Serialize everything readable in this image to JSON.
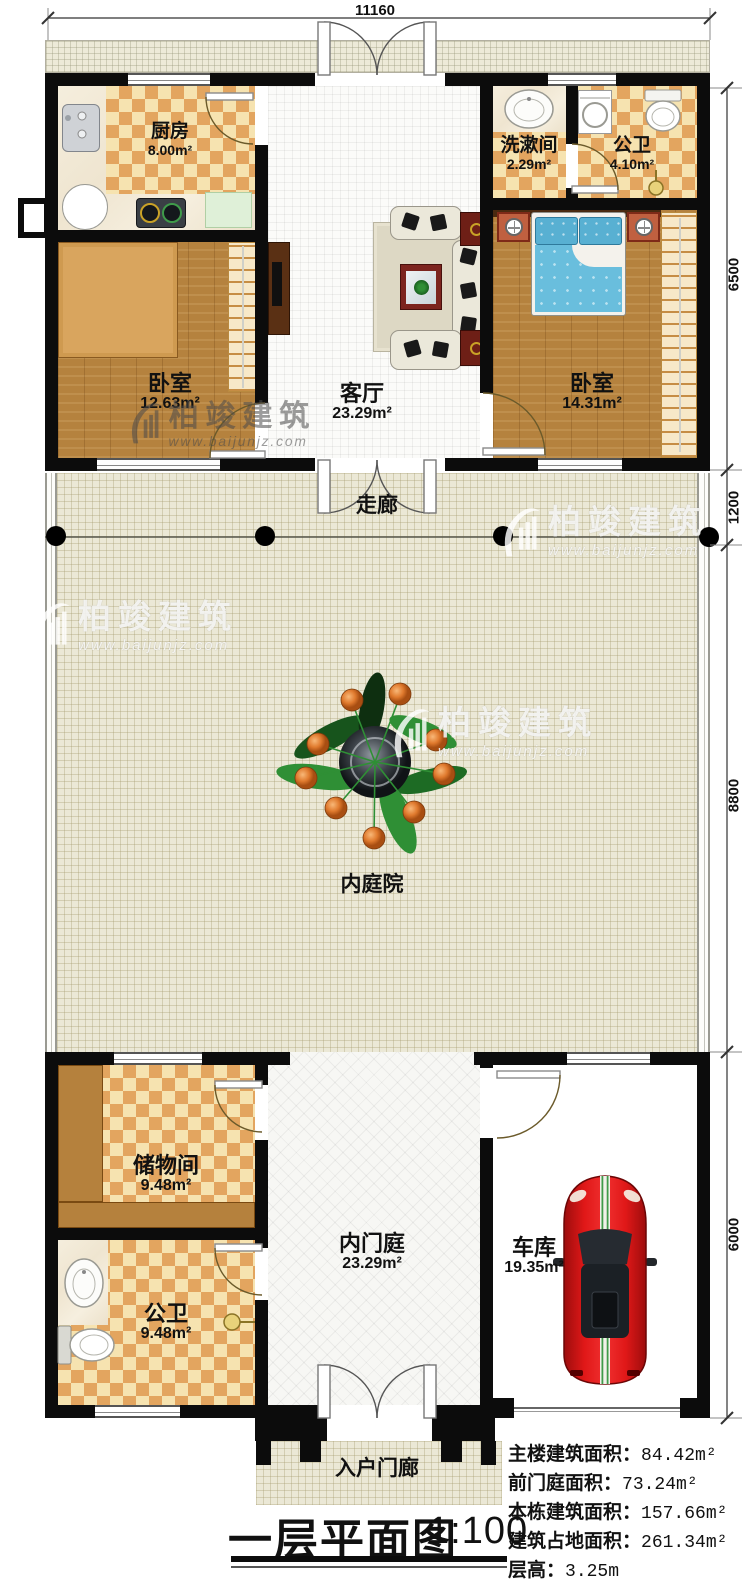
{
  "plan": {
    "title": "一层平面图",
    "scale": "1:100",
    "dim_top": "11160",
    "dims_right": [
      "6500",
      "1200",
      "8800",
      "6000"
    ],
    "rooms": {
      "kitchen": {
        "name": "厨房",
        "area": "8.00m²"
      },
      "washroom": {
        "name": "洗漱间",
        "area": "2.29m²"
      },
      "bath_top": {
        "name": "公卫",
        "area": "4.10m²"
      },
      "bedroom_left": {
        "name": "卧室",
        "area": "12.63m²"
      },
      "living_room": {
        "name": "客厅",
        "area": "23.29m²"
      },
      "bedroom_right": {
        "name": "卧室",
        "area": "14.31m²"
      },
      "corridor": {
        "name": "走廊"
      },
      "courtyard": {
        "name": "内庭院"
      },
      "storage": {
        "name": "储物间",
        "area": "9.48m²"
      },
      "bath_bottom": {
        "name": "公卫",
        "area": "9.48m²"
      },
      "inner_foyer": {
        "name": "内门庭",
        "area": "23.29m²"
      },
      "garage": {
        "name": "车库",
        "area": "19.35m²"
      },
      "entry_porch": {
        "name": "入户门廊"
      }
    },
    "info": [
      {
        "label": "主楼建筑面积：",
        "value": "84.42m²"
      },
      {
        "label": "前门庭面积：",
        "value": "73.24m²"
      },
      {
        "label": "本栋建筑面积：",
        "value": "157.66m²"
      },
      {
        "label": "建筑占地面积：",
        "value": "261.34m²"
      },
      {
        "label": "层高：",
        "value": "3.25m"
      }
    ],
    "watermark": {
      "brand": "柏竣建筑",
      "url": "www.baijunjz.com"
    },
    "colors": {
      "wall": "#0c0c0c",
      "checker_dark": "#e3a55f",
      "checker_light": "#f6e3b0",
      "floor_beige": "#ebe8d6",
      "wood": "#b5823e",
      "bed_blue": "#69bedd",
      "car_red": "#d31414"
    }
  }
}
